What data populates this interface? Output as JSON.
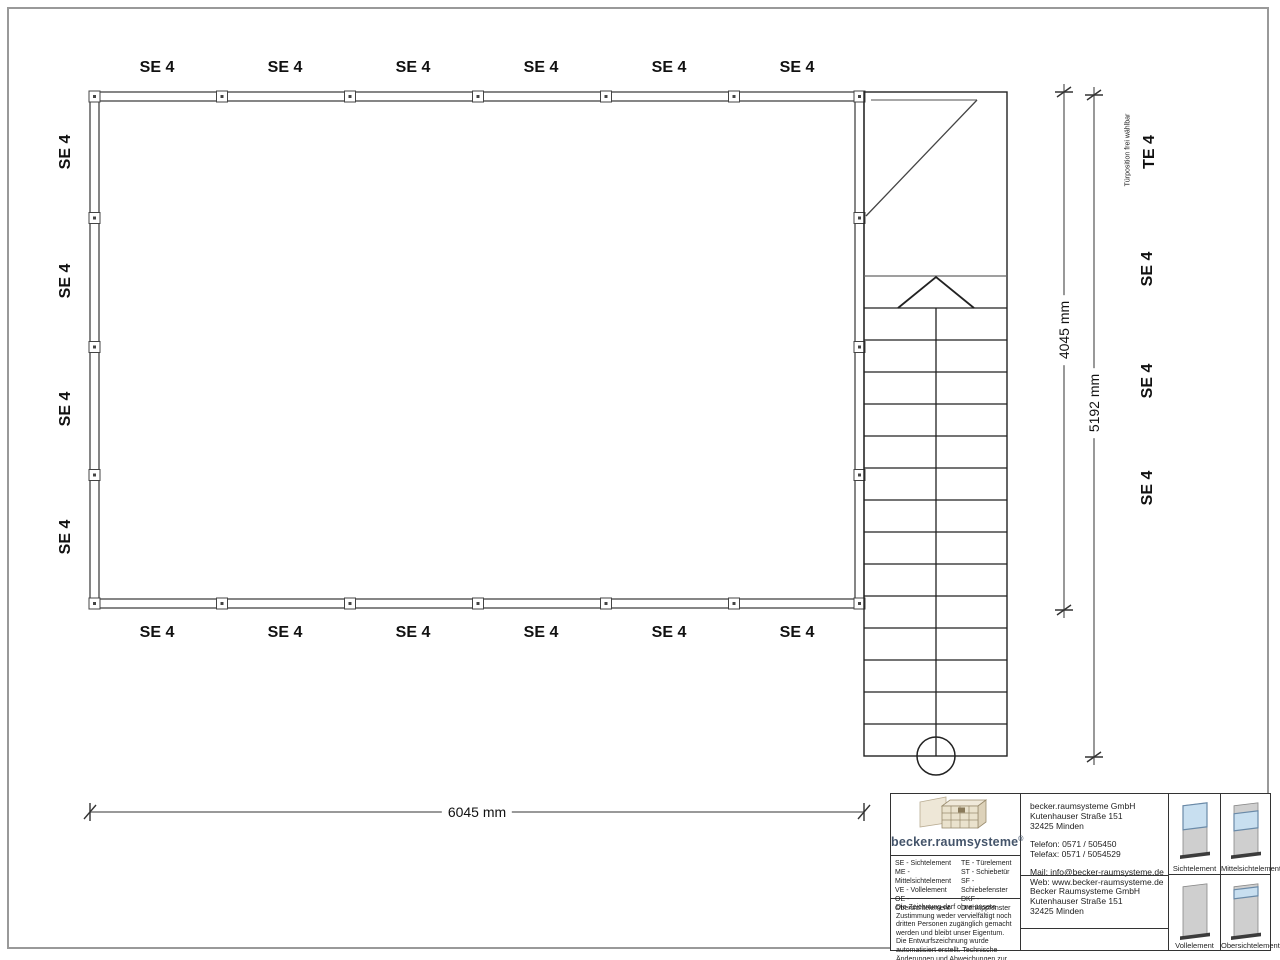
{
  "plan": {
    "top_labels": [
      "SE 4",
      "SE 4",
      "SE 4",
      "SE 4",
      "SE 4",
      "SE 4"
    ],
    "bottom_labels": [
      "SE 4",
      "SE 4",
      "SE 4",
      "SE 4",
      "SE 4",
      "SE 4"
    ],
    "left_labels": [
      "SE 4",
      "SE 4",
      "SE 4",
      "SE 4"
    ],
    "right_labels": [
      "TE 4",
      "SE 4",
      "SE 4",
      "SE 4"
    ],
    "door_note": "Türposition frei wählbar"
  },
  "dimensions": {
    "width": "6045 mm",
    "room_height": "4045 mm",
    "total_height": "5192 mm"
  },
  "title_block": {
    "logo_text": "becker.raumsysteme",
    "logo_mark": "®",
    "legend": {
      "col1": [
        "SE - Sichtelement",
        "ME - Mittelsichtelement",
        "VE - Vollelement",
        "OE - Obersichtelement"
      ],
      "col2": [
        "TE - Türelement",
        "ST - Schiebetür",
        "SF - Schiebefenster",
        "DKF - Drehkippfenster"
      ]
    },
    "disclaimer": "Die Zeichnung darf ohne unsere Zustimmung weder vervielfältigt noch dritten Personen zugänglich gemacht werden und bleibt unser Eigentum. Die Entwurfszeichnung wurde automatisiert erstellt. Technische Änderungen und Abweichungen zur Ausführungszeichnung behalten wir uns vor.",
    "contact": {
      "company": "becker.raumsysteme GmbH",
      "street": "Kutenhauser Straße 151",
      "city": "32425 Minden",
      "phone": "Telefon: 0571 / 505450",
      "fax": "Telefax: 0571 / 5054529",
      "mail": "Mail: info@becker-raumsysteme.de",
      "web": "Web: www.becker-raumsysteme.de"
    },
    "owner": {
      "company": "Becker Raumsysteme GmbH",
      "street": "Kutenhauser Straße 151",
      "city": "32425 Minden"
    },
    "elements": [
      {
        "caption": "Sichtelement"
      },
      {
        "caption": "Mittelsichtelement"
      },
      {
        "caption": "Vollelement"
      },
      {
        "caption": "Obersichtelement"
      }
    ],
    "colors": {
      "glass": "#c8dff0",
      "panel": "#cfcfcf",
      "base": "#3c3c3c",
      "logo_text": "#44546a"
    }
  }
}
